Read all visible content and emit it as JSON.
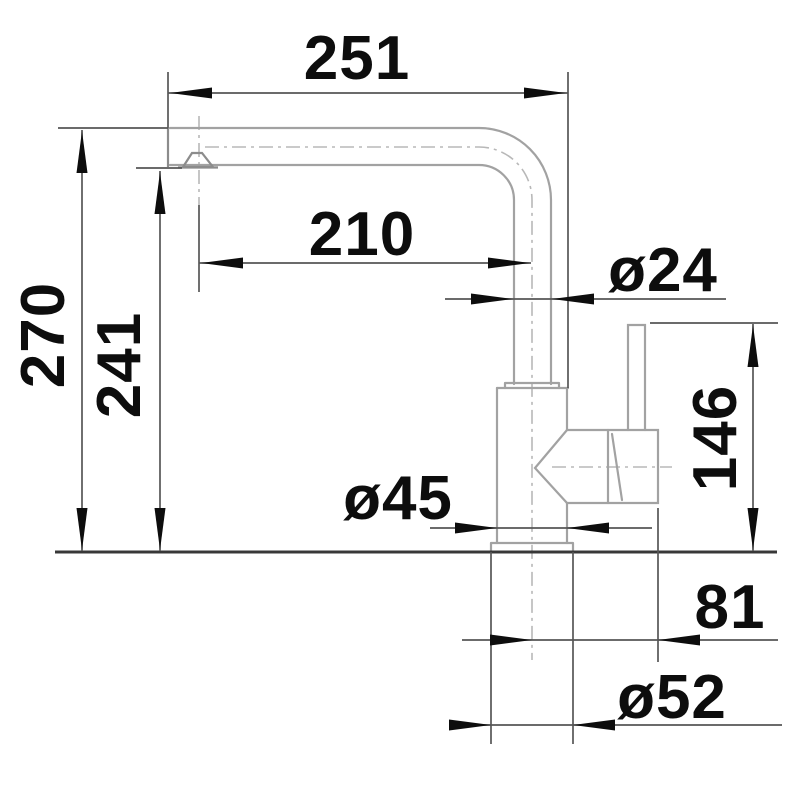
{
  "drawing": {
    "kind": "faucet-dimension-diagram",
    "units": "mm",
    "background_color": "#ffffff",
    "outline_color": "#a2a2a2",
    "dimension_line_color": "#565656",
    "text_color": "#0d0d0d",
    "labels": {
      "reach_overall": "251",
      "reach_to_outlet": "210",
      "spout_tube_diameter": "ø24",
      "height_overall": "270",
      "height_to_outlet": "241",
      "height_lever_top": "146",
      "body_diameter": "ø45",
      "lever_offset": "81",
      "base_diameter": "ø52"
    }
  }
}
